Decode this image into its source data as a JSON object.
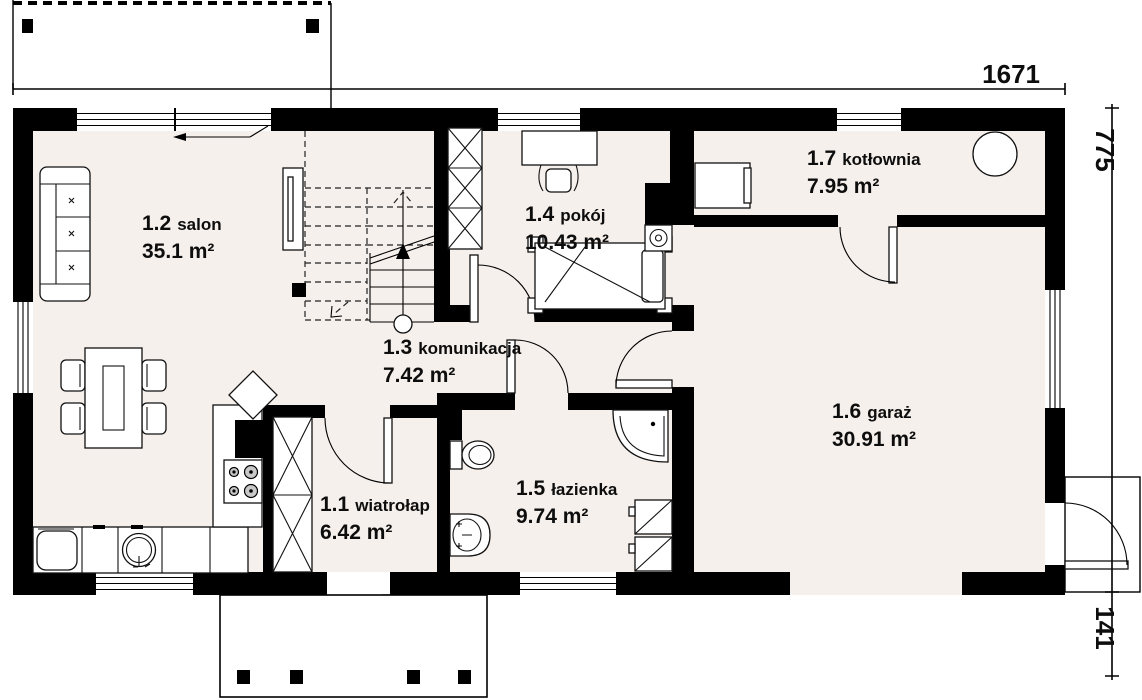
{
  "page": {
    "type": "architectural-floor-plan",
    "floor_label": "parter"
  },
  "rooms": [
    {
      "number": "1.1",
      "name": "wiatrołap",
      "area": "6.42 m²"
    },
    {
      "number": "1.2",
      "name": "salon",
      "area": "35.1 m²"
    },
    {
      "number": "1.3",
      "name": "komunikacja",
      "area": "7.42 m²"
    },
    {
      "number": "1.4",
      "name": "pokój",
      "area": "10.43 m²"
    },
    {
      "number": "1.5",
      "name": "łazienka",
      "area": "9.74 m²"
    },
    {
      "number": "1.6",
      "name": "garaż",
      "area": "30.91 m²"
    },
    {
      "number": "1.7",
      "name": "kotłownia",
      "area": "7.95 m²"
    }
  ],
  "dimensions": {
    "total_width": "1671",
    "total_height": "775",
    "side_entry": "141"
  },
  "colors": {
    "floor": "#f6f0ec",
    "wall": "#000000"
  }
}
